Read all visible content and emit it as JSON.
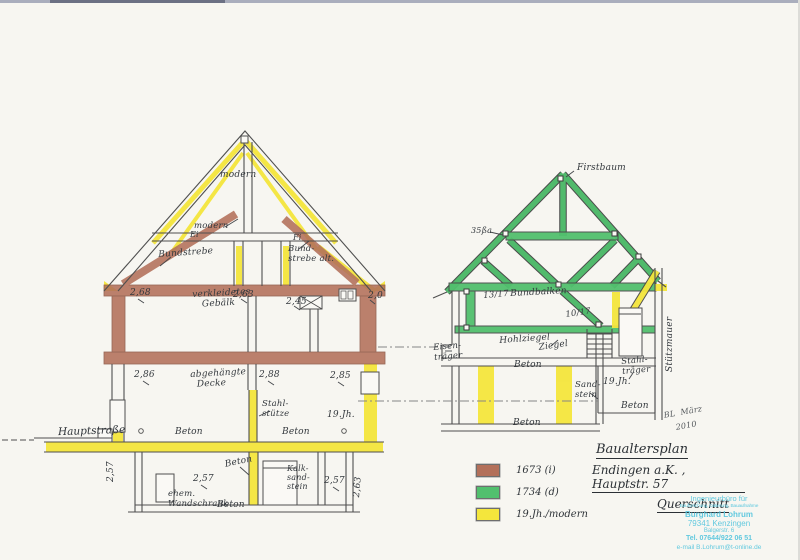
{
  "document": {
    "title_block": {
      "line1": "Baualtersplan",
      "line2": "Endingen a.K. , Hauptstr. 57",
      "line3": "Querschnitt"
    },
    "street_label": "Hauptstraße",
    "date_note_line1": "BL  März",
    "date_note_line2": "2010"
  },
  "legend": {
    "items": [
      {
        "label": "1673 (i)",
        "color": "#b3705a"
      },
      {
        "label": "1734 (d)",
        "color": "#52c06e"
      },
      {
        "label": "19.Jh./modern",
        "color": "#f4e63c"
      }
    ]
  },
  "stamp": {
    "color": "#62c9df",
    "line1": "Ingenieurbüro für",
    "line2": "Bauforschung, Datierung, Bauaufnahme",
    "line3": "Burghard Lohrum",
    "line4": "79341 Kenzingen",
    "line5": "Balgerstr. 6",
    "line6": "Tel. 07644/922 06 51",
    "line7": "e-mail B.Lohrum@t-online.de"
  },
  "annotations": [
    {
      "id": "modern-roof-top",
      "text": "modern",
      "x": 220,
      "y": 170
    },
    {
      "id": "modern-collar",
      "text": "modern",
      "x": 194,
      "y": 222,
      "fs": 8.5
    },
    {
      "id": "bundstrebe",
      "text": "Bundstrebe",
      "x": 158,
      "y": 250,
      "fs": 9,
      "rot": -4
    },
    {
      "id": "species-ei",
      "text": "Ei",
      "x": 190,
      "y": 231,
      "fs": 8
    },
    {
      "id": "species-fi",
      "text": "Fi",
      "x": 293,
      "y": 234,
      "fs": 8
    },
    {
      "id": "bundstrebe-alt",
      "text": "Bund-\nstrebe alt.",
      "x": 288,
      "y": 245,
      "fs": 8.5
    },
    {
      "id": "dim-268",
      "text": "2,68",
      "x": 130,
      "y": 288
    },
    {
      "id": "verkleidetes-gebaelk",
      "text": "verkleidetes\n   Gebälk",
      "x": 192,
      "y": 290,
      "rot": -3
    },
    {
      "id": "dim-263",
      "text": "2,63",
      "x": 233,
      "y": 290
    },
    {
      "id": "dim-245",
      "text": "2,45",
      "x": 286,
      "y": 297
    },
    {
      "id": "dim-20",
      "text": "2,0",
      "x": 368,
      "y": 291
    },
    {
      "id": "dim-286",
      "text": "2,86",
      "x": 134,
      "y": 370
    },
    {
      "id": "abgehaengte-decke",
      "text": "abgehängte\n  Decke",
      "x": 190,
      "y": 370,
      "rot": -3
    },
    {
      "id": "dim-288",
      "text": "2,88",
      "x": 259,
      "y": 370
    },
    {
      "id": "dim-285",
      "text": "2,85",
      "x": 330,
      "y": 371
    },
    {
      "id": "stahlstuetze-left",
      "text": "Stahl-\nstütze",
      "x": 262,
      "y": 400,
      "fs": 8.5
    },
    {
      "id": "jh19-left",
      "text": "19.Jh.",
      "x": 327,
      "y": 410
    },
    {
      "id": "beton-eg-left",
      "text": "Beton",
      "x": 175,
      "y": 427
    },
    {
      "id": "beton-eg-right",
      "text": "Beton",
      "x": 282,
      "y": 427
    },
    {
      "id": "dim-257-rot",
      "text": "2,57",
      "x": 106,
      "y": 482,
      "rot": -90
    },
    {
      "id": "dim-257-a",
      "text": "2,57",
      "x": 193,
      "y": 474
    },
    {
      "id": "beton-kg-arrow",
      "text": "Beton",
      "x": 224,
      "y": 460,
      "rot": -12
    },
    {
      "id": "kalksandstein",
      "text": "Kalk-\nsand-\nstein",
      "x": 287,
      "y": 465,
      "fs": 8
    },
    {
      "id": "dim-257-b",
      "text": "2,57",
      "x": 324,
      "y": 476
    },
    {
      "id": "dim-263-rot",
      "text": "2,63",
      "x": 352,
      "y": 497,
      "rot": -85
    },
    {
      "id": "ehem-wandschrank",
      "text": "ehem.\nWandschrank",
      "x": 168,
      "y": 490,
      "fs": 8.5
    },
    {
      "id": "beton-kg-bottom",
      "text": "Beton",
      "x": 217,
      "y": 500
    },
    {
      "id": "firstbaum",
      "text": "Firstbaum",
      "x": 577,
      "y": 163
    },
    {
      "id": "collar-note",
      "text": "35ßa",
      "x": 471,
      "y": 227,
      "fs": 8
    },
    {
      "id": "dim-13-17",
      "text": "13/17",
      "x": 483,
      "y": 292,
      "fs": 8.5,
      "rot": -5
    },
    {
      "id": "bundbalken",
      "text": "Bundbalken",
      "x": 510,
      "y": 289,
      "rot": -3
    },
    {
      "id": "dim-10-17",
      "text": "10/17",
      "x": 565,
      "y": 311,
      "fs": 8.5,
      "rot": -8
    },
    {
      "id": "hohlziegel",
      "text": "Hohlziegel",
      "x": 499,
      "y": 336,
      "rot": -4
    },
    {
      "id": "ziegel",
      "text": "Ziegel",
      "x": 538,
      "y": 343,
      "rot": -8
    },
    {
      "id": "eisentraeger",
      "text": "Eisen-\nträger",
      "x": 433,
      "y": 344,
      "fs": 8.5,
      "rot": -5
    },
    {
      "id": "beton-right-slab",
      "text": "Beton",
      "x": 514,
      "y": 360
    },
    {
      "id": "stahltraeger-right",
      "text": "Stahl-\nträger",
      "x": 621,
      "y": 358,
      "fs": 8.5,
      "rot": -5
    },
    {
      "id": "jh19-right",
      "text": "19.Jh.",
      "x": 603,
      "y": 377
    },
    {
      "id": "sandstein",
      "text": "Sand-\nstein",
      "x": 575,
      "y": 381,
      "fs": 8.5
    },
    {
      "id": "beton-right-mid",
      "text": "Beton",
      "x": 621,
      "y": 401
    },
    {
      "id": "beton-right-floor",
      "text": "Beton",
      "x": 513,
      "y": 418
    },
    {
      "id": "stuetzmauer",
      "text": "Stützmauer",
      "x": 665,
      "y": 372,
      "rot": -90
    }
  ]
}
